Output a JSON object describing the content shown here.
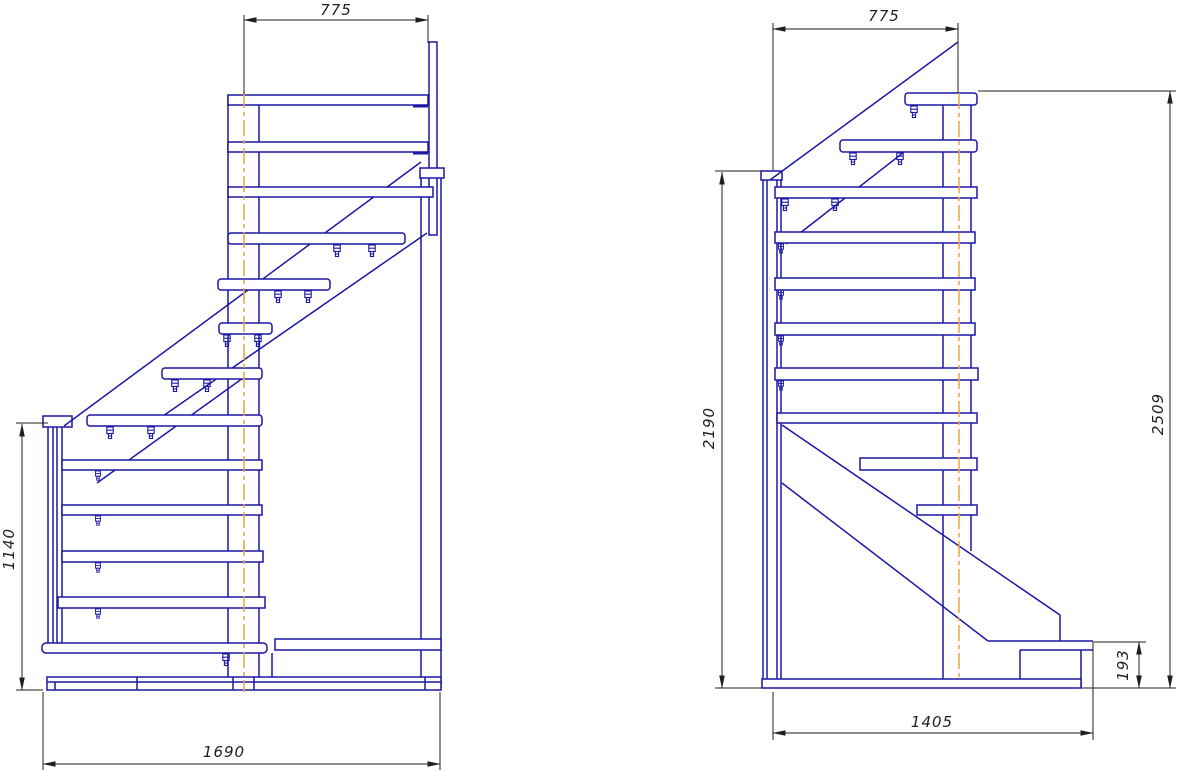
{
  "page": {
    "title": "Staircase assembly drawing - two side elevations"
  },
  "drawing": {
    "left_view": {
      "name": "side-elevation-left",
      "dimensions": {
        "top_width": "775",
        "left_height": "1140",
        "bottom_width": "1690"
      }
    },
    "right_view": {
      "name": "side-elevation-right",
      "dimensions": {
        "top_width": "775",
        "inner_height": "2190",
        "outer_height": "2509",
        "step_height": "193",
        "bottom_width": "1405"
      }
    },
    "colors": {
      "line_blue": "#1c17a5",
      "centerline_orange": "#efa23c",
      "dim_black": "#1f1f1f",
      "background": "#ffffff"
    }
  }
}
